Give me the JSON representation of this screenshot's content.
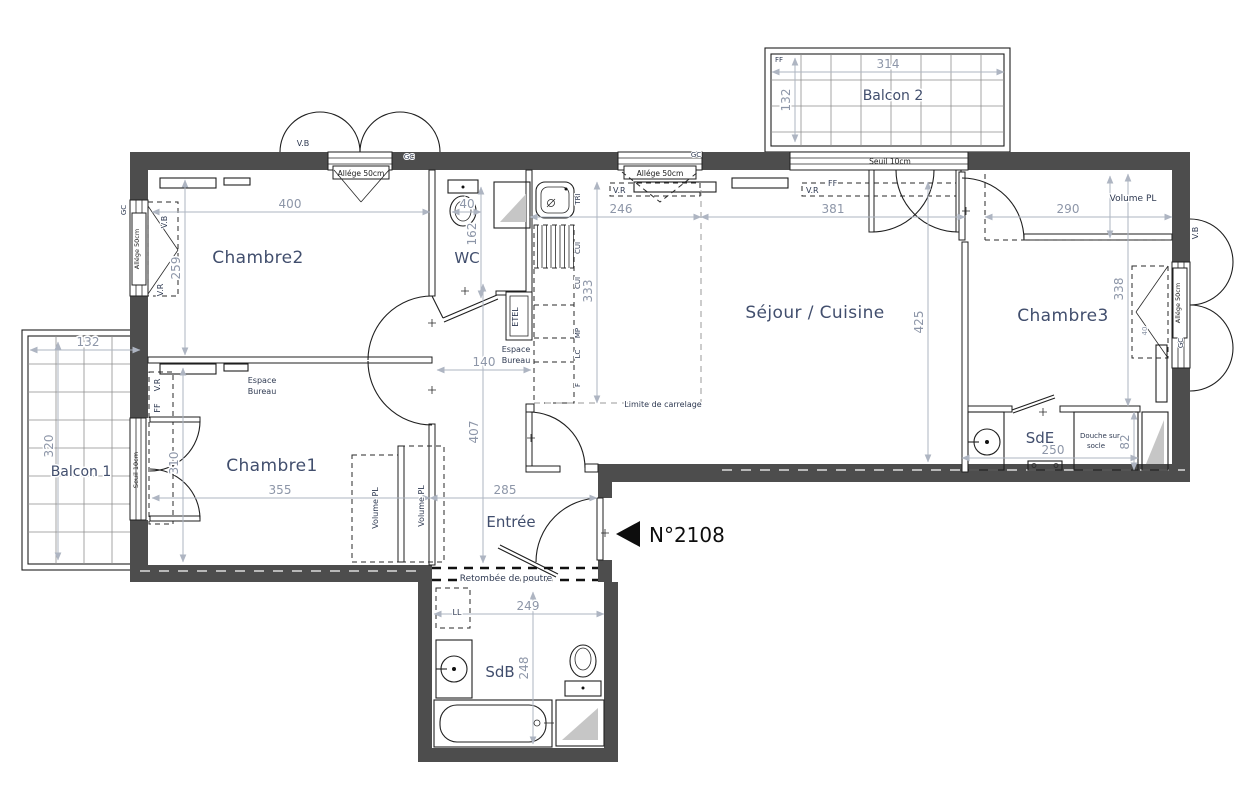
{
  "unit": {
    "number": "N°2108"
  },
  "rooms": {
    "chambre1": "Chambre1",
    "chambre2": "Chambre2",
    "chambre3": "Chambre3",
    "sejour": "Séjour / Cuisine",
    "wc": "WC",
    "sde": "SdE",
    "sdb": "SdB",
    "entree": "Entrée",
    "balcon1": "Balcon 1",
    "balcon2": "Balcon 2"
  },
  "dims": {
    "c2_w": "400",
    "c2_h": "259",
    "wc_w": "40",
    "wc_h": "162",
    "kit_w": "246",
    "kit_h": "333",
    "sej_w": "381",
    "sej_h": "425",
    "c3_w": "290",
    "c3_h": "338",
    "c3_win": "40",
    "hall_w": "140",
    "hall_h": "407",
    "c1_w": "355",
    "c1_h": "310",
    "ent_w": "285",
    "b1_w": "132",
    "b1_h": "320",
    "b2_w": "314",
    "b2_h": "132",
    "sde_w": "250",
    "douche_h": "82",
    "sdb_w": "249",
    "sdb_h": "248"
  },
  "labels": {
    "allege": "Allége 50cm",
    "seuil": "Seuil 10cm",
    "vr": "V.R",
    "vb": "V.B",
    "ff": "FF",
    "gc": "GC",
    "volume_pl": "Volume PL",
    "espace": "Espace",
    "bureau": "Bureau",
    "limite": "Limite de carrelage",
    "retombee": "Retombée de poutre",
    "douche1": "Douche sur",
    "douche2": "socle",
    "ll": "LL",
    "etel": "ETEL",
    "tri": "TRI",
    "cui": "CUI",
    "mp": "MP",
    "lc": "LC",
    "f": "F"
  }
}
